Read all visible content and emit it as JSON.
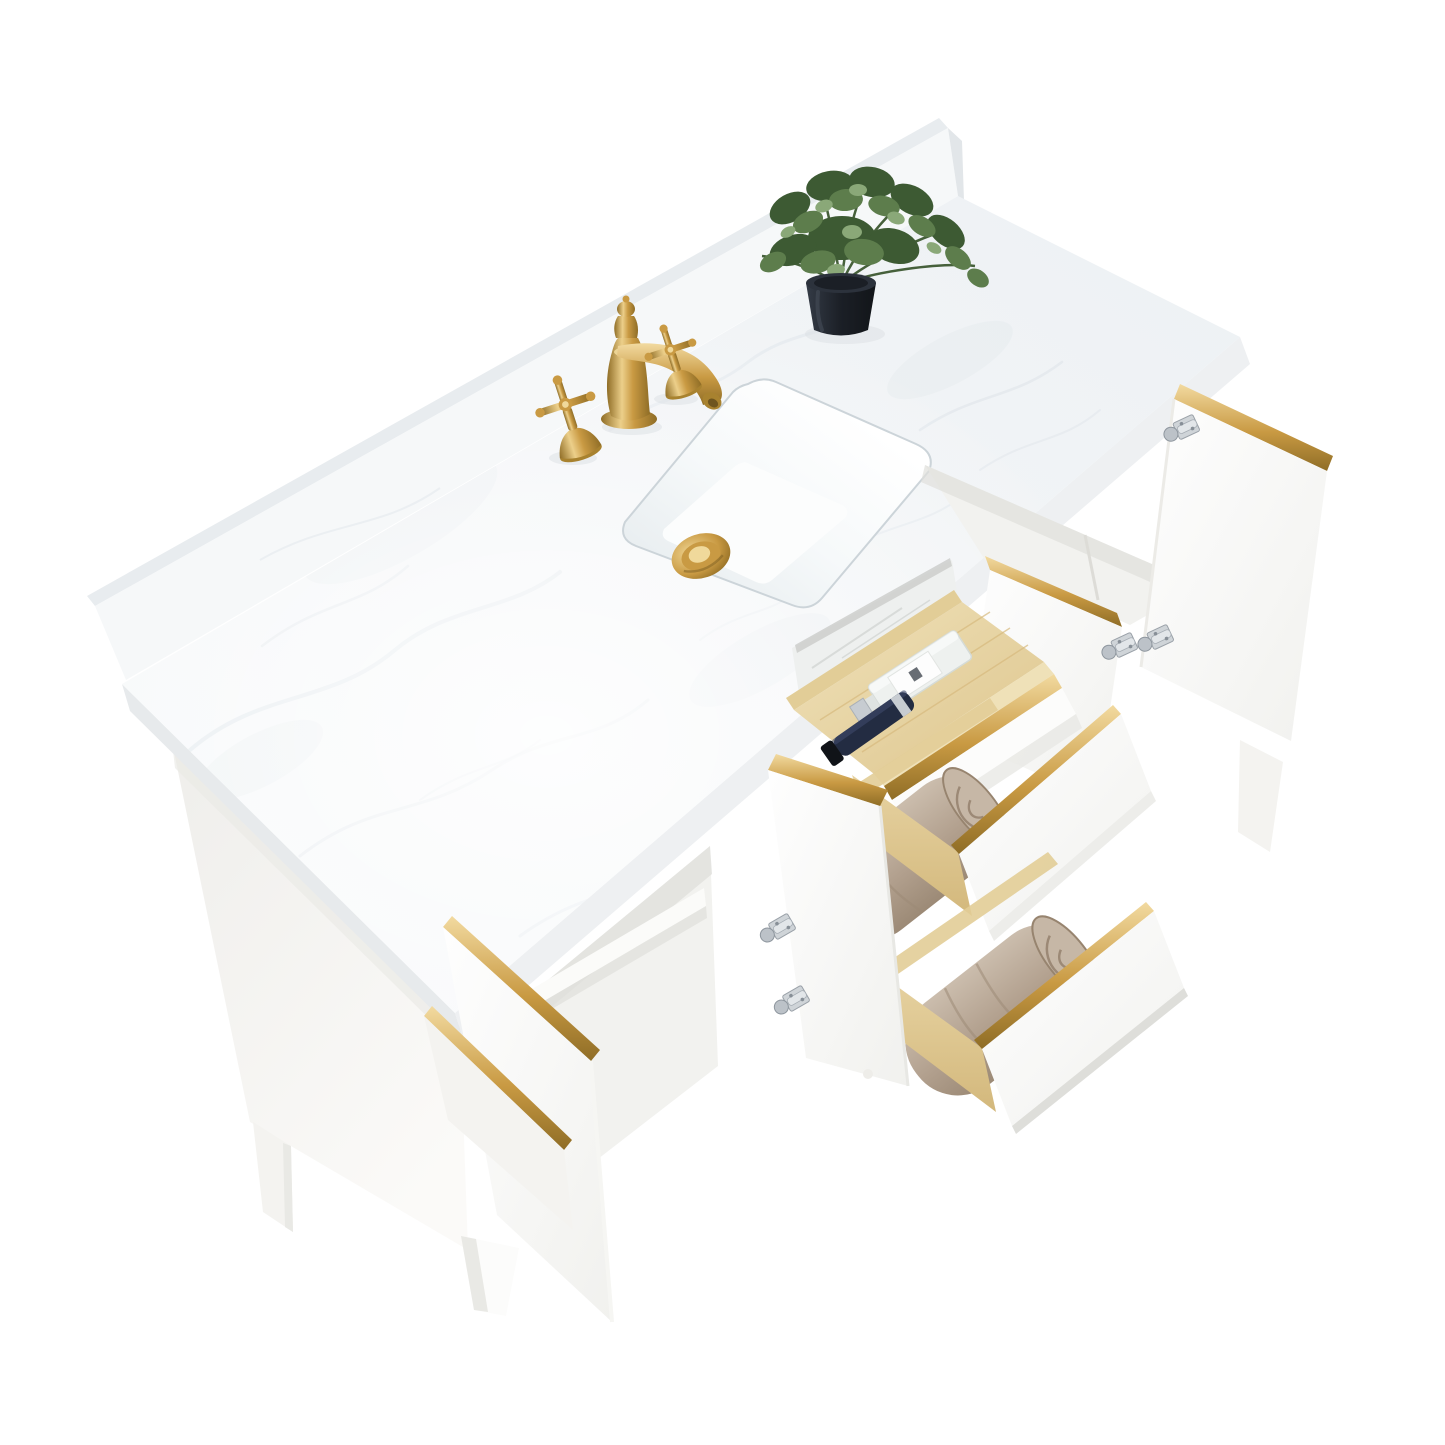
{
  "scene": {
    "title": "White and gold bathroom vanity with marble top, open doors and drawers — studio product photo",
    "type": "product-photograph",
    "background": "seamless white studio backdrop",
    "vanity": {
      "countertop": "white engineered marble countertop with rear backsplash",
      "sink": "rectangular white ceramic undermount sink",
      "drain": "brushed gold pop-up drain",
      "faucet": "brushed gold widespread faucet with curved spout and two cross handles",
      "plant": "green artificial plant in black tapered pot",
      "cabinet_finish": "matte white",
      "hardware": "brushed gold edge pulls on doors and drawers",
      "hinges": "polished nickel concealed euro hinges",
      "doors_open_count": 4,
      "drawers_open_count": 3,
      "tray_contents": [
        "clear glass perfume bottle with white label",
        "navy blue cosmetic bottle with silver band"
      ],
      "middle_drawer_contents": "folded taupe towel",
      "bottom_drawer_contents": "folded taupe towel",
      "drawer_boxes": "natural pine wood",
      "interior": "open cabinet bays with white adjustable shelf",
      "legs": "tapered white wood feet"
    }
  },
  "colors": {
    "background": "#ffffff",
    "marble_vein": "#dbe2e8",
    "marble_edge_left": "#e7eaec",
    "marble_edge_front": "#eef0f2",
    "backsplash_face": "#f6f8f9",
    "backsplash_top": "#e8ecef",
    "backsplash_end": "#e2e6e9",
    "ceramic_white": "#ffffff",
    "ceramic_shade": "#e7edf0",
    "basin_floor": "#fcfdfd",
    "rim_line": "#ccd4d9",
    "gold_light": "#f0d99b",
    "gold_mid": "#c99a43",
    "gold_deep": "#a8822f",
    "gold_dark": "#8f6d26",
    "gold_core": "#6f551e",
    "pine_light": "#efe1b8",
    "pine_mid": "#e2cd97",
    "pine_dark": "#d7ba7e",
    "towel_light": "#cbbdad",
    "towel_mid": "#b2a08e",
    "towel_dark": "#93816d",
    "towel_line": "#8d7a66",
    "pot_dark": "#1b1f26",
    "pot_mid": "#2c323c",
    "pot_light": "#4a525e",
    "leaf_dark": "#3d5a33",
    "leaf_mid": "#5d7d4c",
    "leaf_light": "#8aa878",
    "stem_green": "#46603b",
    "cabinet_white": "#fcfcfb",
    "cabinet_soft": "#f4f3f0",
    "cabinet_shade": "#e9e9e5",
    "cabinet_deep": "#dededa",
    "interior_wall": "#f2f2ef",
    "interior_shadow": "#e0e0dc",
    "shelf_white": "#fbfbf9",
    "slit_dark": "#caccc9",
    "mirror_panel": "#eef0ef",
    "mirror_streak": "#d8dbd9",
    "nickel_light": "#e2e6e9",
    "nickel_mid": "#c0c6cc",
    "nickel_dark": "#8e969e",
    "glass_clear": "#eef1ef",
    "glass_edge": "#d5dbd7",
    "label_white": "#fdfdfd",
    "label_mark": "#4e545c",
    "navy_bottle": "#232c42",
    "navy_sheen": "#3d4a6b",
    "cap_silver": "#c7ccd1",
    "cap_black": "#101318",
    "counter_shadow": "#dbe0e4"
  }
}
